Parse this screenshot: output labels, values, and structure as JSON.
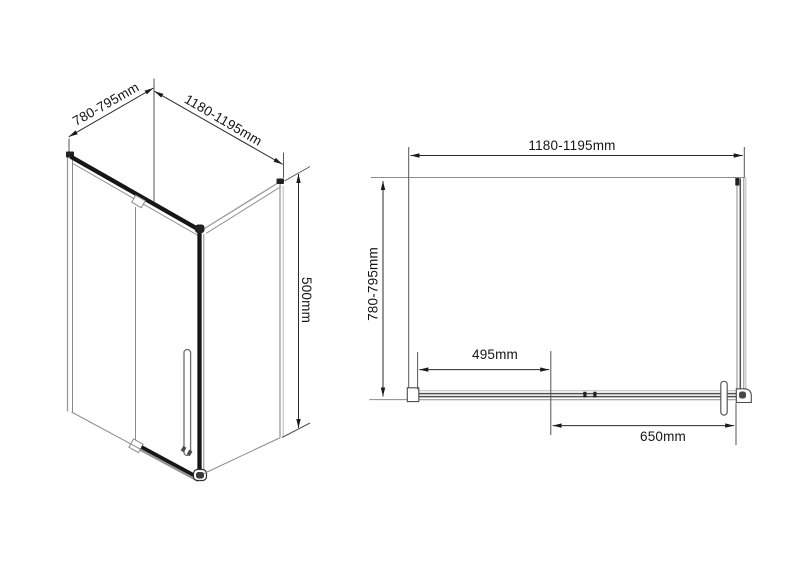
{
  "figure": {
    "background": "#ffffff",
    "line_color_dark": "#1a1a1a",
    "line_color_gray": "#8a8a8a",
    "dimension_line_color": "#2a2a2a",
    "text_color": "#141414"
  },
  "iso_view": {
    "depth_label": "780-795mm",
    "width_label": "1180-1195mm",
    "height_label": "500mm"
  },
  "plan_view": {
    "width_label": "1180-1195mm",
    "depth_label": "780-795mm",
    "left_span_label": "495mm",
    "right_span_label": "650mm"
  }
}
